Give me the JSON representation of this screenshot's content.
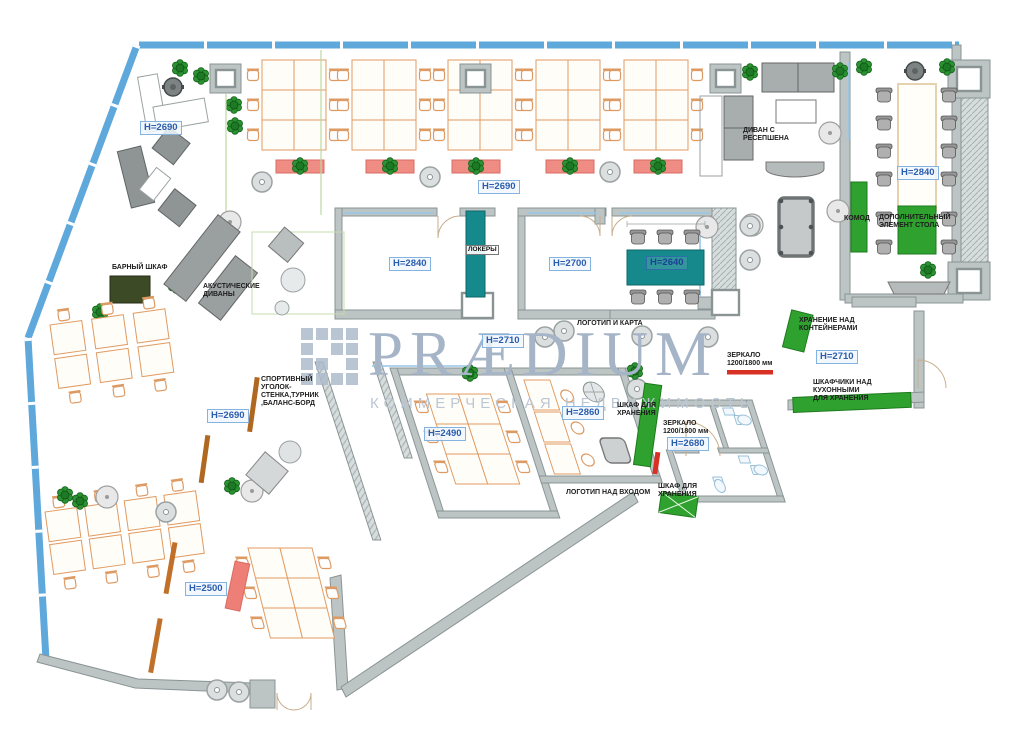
{
  "title": "Офисная планировка (план расстановки мебели)",
  "watermark": {
    "logo": "PRÆDIUM",
    "tagline": "КОММЕРЧЕСКАЯ НЕДВИЖИМОСТЬ"
  },
  "heights": {
    "left_top": "H=2690",
    "top_center": "H=2690",
    "dining": "H=2840",
    "room_a": "H=2840",
    "room_b": "H=2700",
    "meeting_table": "H=2640",
    "corridor": "H=2710",
    "kitchen": "H=2710",
    "left_mid": "H=2690",
    "room_c": "H=2490",
    "room_d": "H=2860",
    "wc": "H=2680",
    "open_bottom": "H=2500"
  },
  "annotations": {
    "reception_sofa": [
      "ДИВАН С",
      "РЕСЕПШЕНА"
    ],
    "komod": "КОМОД",
    "table_extra": [
      "ДОПОЛНИТЕЛЬНЫЙ",
      "ЭЛЕМЕНТ СТОЛА"
    ],
    "lockers": "ЛОКЕРЫ",
    "logo_map": "ЛОГОТИП И КАРТА",
    "storage_over_containers": [
      "ХРАНЕНИЕ НАД",
      "КОНТЕЙНЕРАМИ"
    ],
    "kitchen_mirror": [
      "ЗЕРКАЛО",
      "1200/1800 мм"
    ],
    "kitchen_cabinets": [
      "ШКАФЧИКИ НАД",
      "КУХОННЫМИ",
      "ДЛЯ ХРАНЕНИЯ"
    ],
    "bar_cabinet": "БАРНЫЙ ШКАФ",
    "acoustic_sofas": [
      "АКУСТИЧЕСКИЕ",
      "ДИВАНЫ"
    ],
    "sport_corner": [
      "СПОРТИВНЫЙ",
      "УГОЛОК-",
      "СТЕНКА,ТУРНИК",
      ",БАЛАНС-БОРД"
    ],
    "storage_cabinet": [
      "ШКАФ ДЛЯ",
      "ХРАНЕНИЯ"
    ],
    "wc_mirror": [
      "ЗЕРКАЛО",
      "1200/1800 мм"
    ],
    "storage_cabinet2": [
      "ШКАФ ДЛЯ",
      "ХРАНЕНИЯ"
    ],
    "logo_entrance": "ЛОГОТИП НАД ВХОДОМ"
  },
  "colors": {
    "glass_blue": "#5fa8dc",
    "wall_gray": "#bcc4c4",
    "desk_outline_orange": "#e09a60",
    "teal": "#15898c",
    "green": "#2fa12e",
    "plant_green": "#2c9132",
    "planter_red": "#ef8d85",
    "mirror_red": "#d93025",
    "bench_red": "#ee7f76",
    "bar_olive": "#3c4a26",
    "board_orange": "#c07028",
    "label_blue": "#2b5dad",
    "watermark_blue_gray": "#a6b4c7"
  }
}
